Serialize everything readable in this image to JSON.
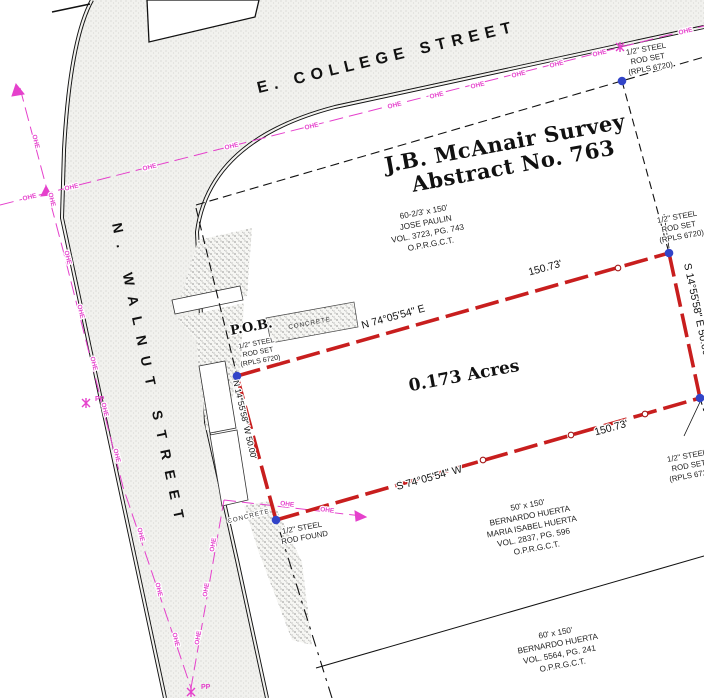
{
  "plat": {
    "survey_name": "J.B. McAnair Survey",
    "survey_abstract": "Abstract No. 763",
    "area_label": "0.173 Acres",
    "pob_label": "P.O.B."
  },
  "streets": {
    "college": "E.  COLLEGE  STREET",
    "walnut": "N.  WALNUT  STREET"
  },
  "bearings": {
    "north_line": "N 74°05'54\" E",
    "south_line": "S 74°05'54\" W",
    "east_line": "S 14°55'58\" E  50.00'",
    "west_line": "N 14°55'58\" W  50.00'",
    "north_dist": "150.73'",
    "south_dist": "150.73'"
  },
  "monuments": {
    "rod_set": [
      "1/2\" STEEL",
      "ROD SET",
      "(RPLS 6720)"
    ],
    "rod_found": [
      "1/2\" STEEL",
      "ROD FOUND"
    ]
  },
  "adjoiners": {
    "paulin": [
      "60-2/3' x 150'",
      "JOSE PAULIN",
      "VOL. 3723, PG. 743",
      "O.P.R.G.C.T."
    ],
    "huerta_south": [
      "50' x 150'",
      "BERNARDO HUERTA",
      "MARIA ISABEL HUERTA",
      "VOL. 2837, PG. 596",
      "O.P.R.G.C.T."
    ],
    "huerta_far_south": [
      "60' x 150'",
      "BERNARDO HUERTA",
      "VOL. 5564, PG. 241",
      "O.P.R.G.C.T."
    ]
  },
  "utilities": {
    "ohe": "OHE",
    "pp": "PP"
  },
  "surfaces": {
    "concrete": "CONCRETE"
  },
  "colors": {
    "boundary_red": "#c81e1e",
    "monument_blue": "#3244c8",
    "overhead_electric_magenta": "#e541cc",
    "street_fill": "#f1f1ee"
  }
}
